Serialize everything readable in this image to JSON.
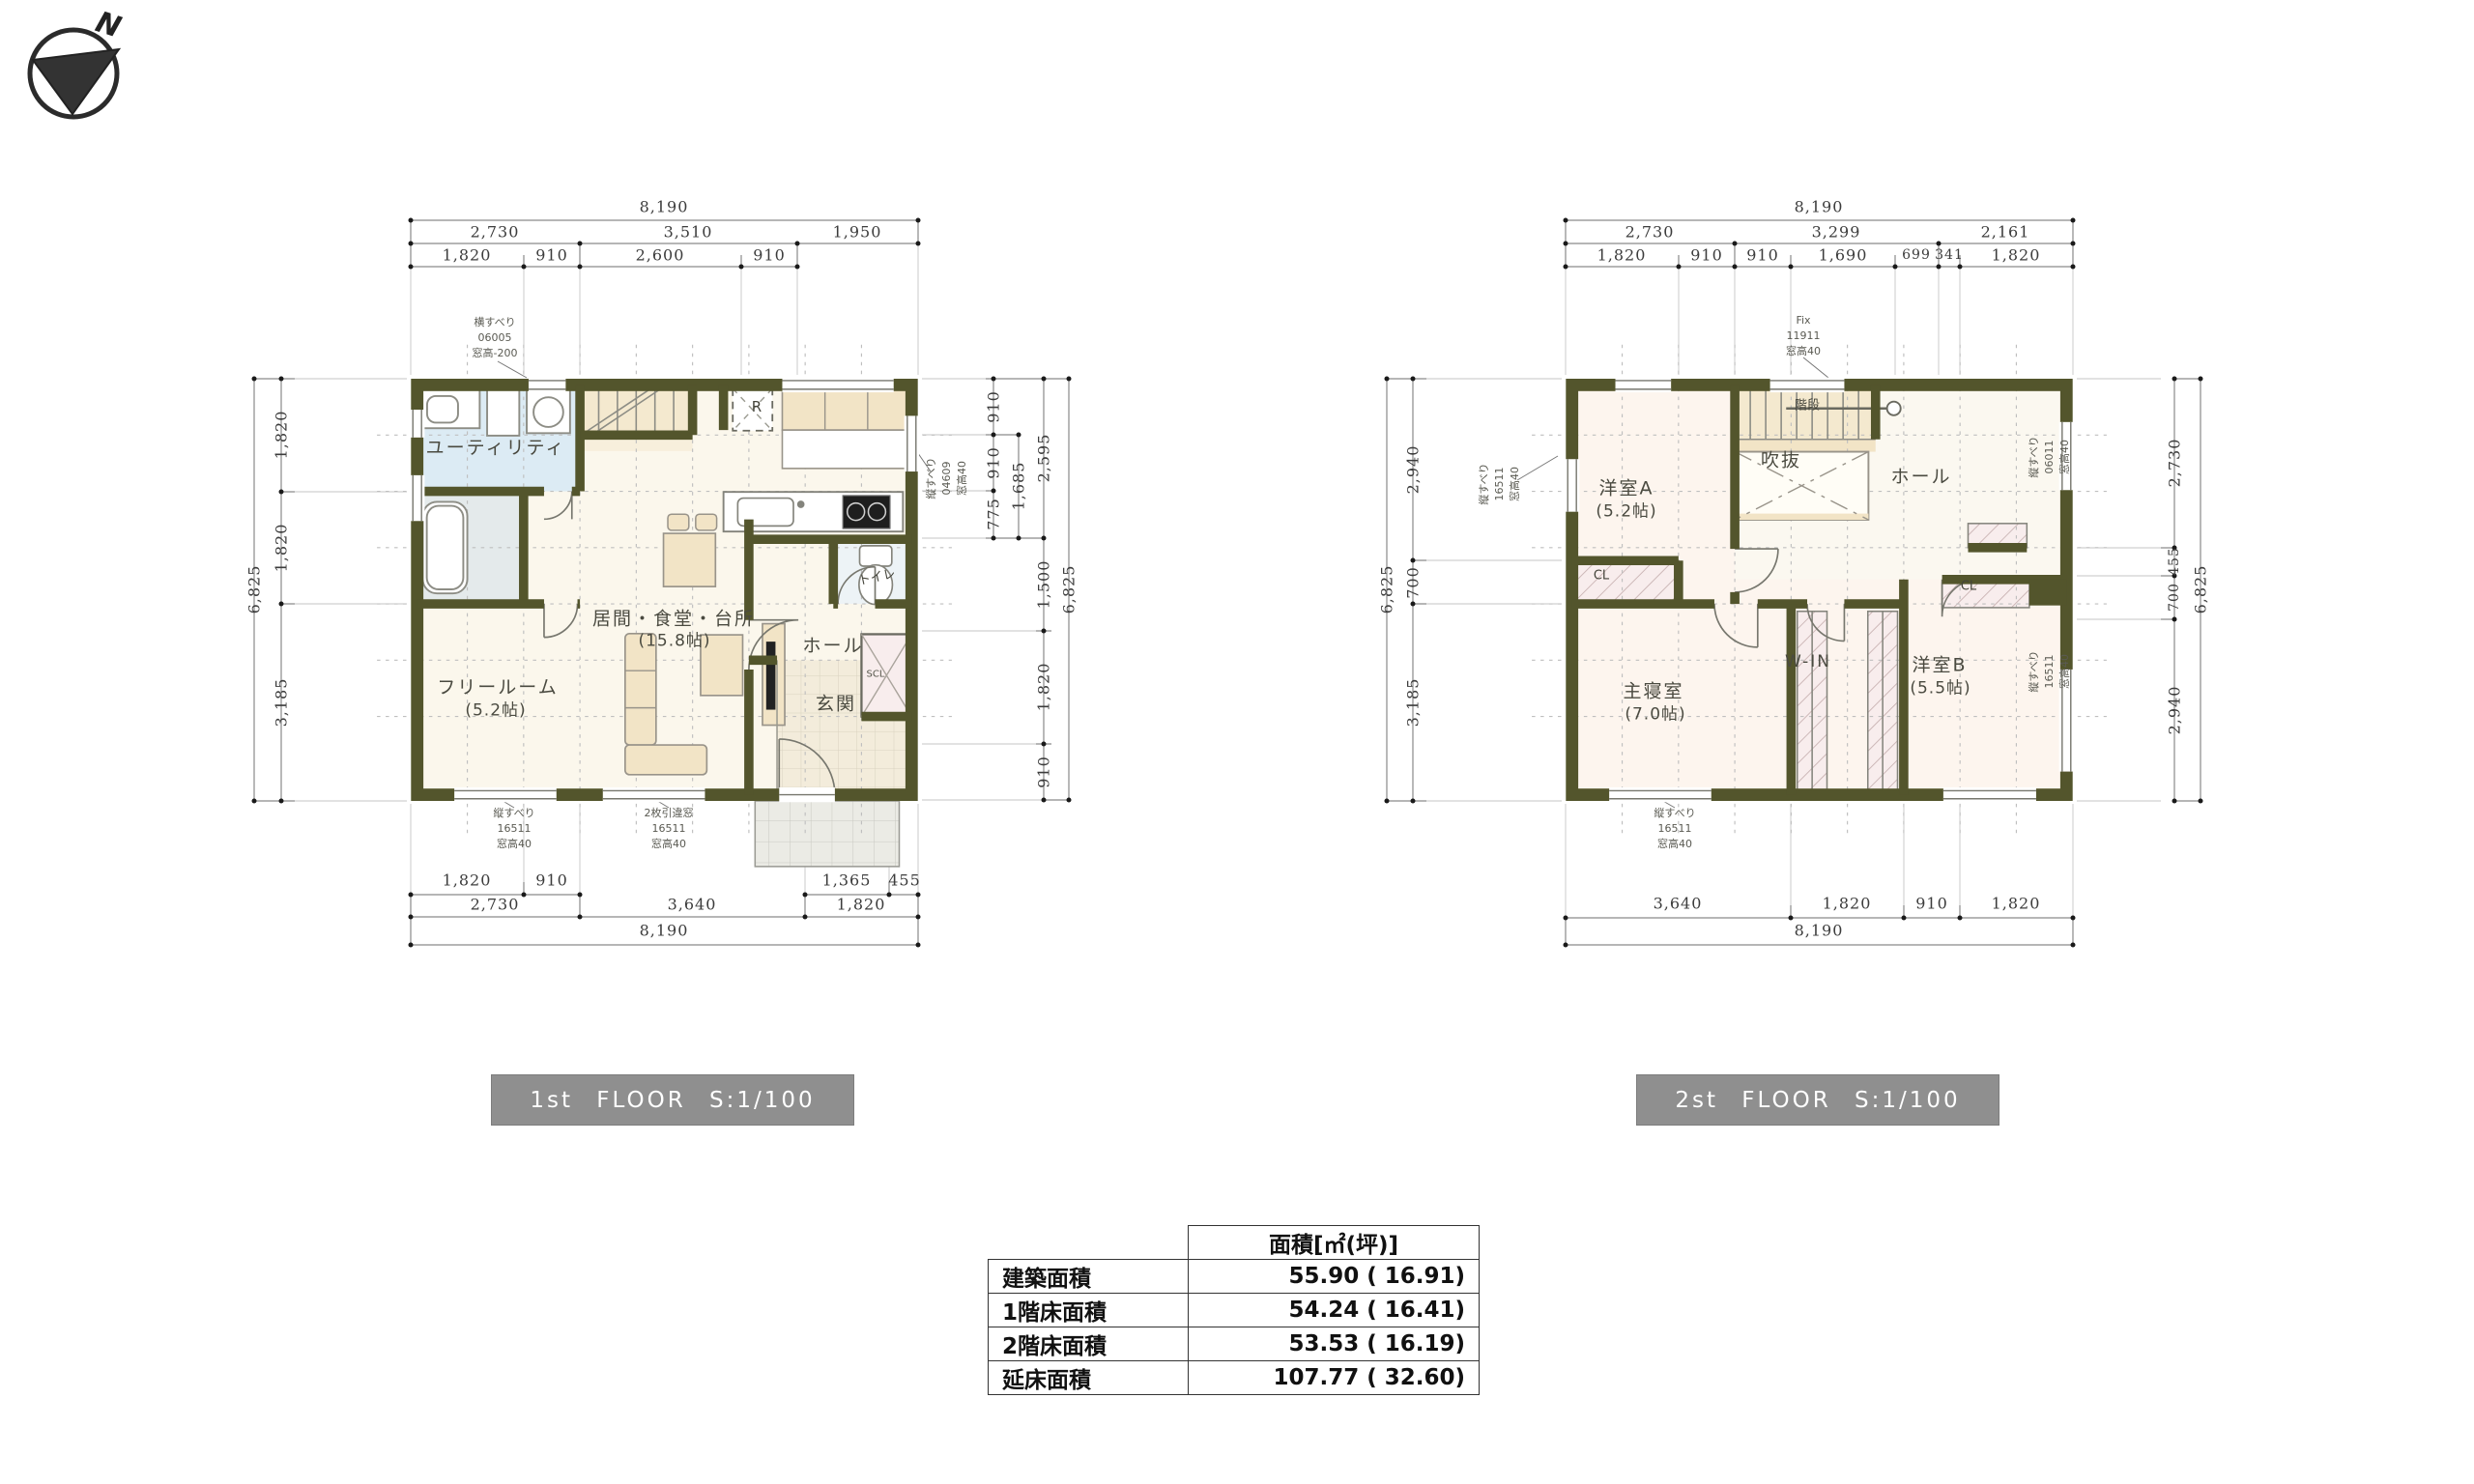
{
  "compass": {
    "north_label": "N"
  },
  "floor1": {
    "badge_label": "1st FLOOR S:1/100",
    "rooms": {
      "utility": "ユーティリティ",
      "free_room": "フリールーム",
      "free_room_size": "(5.2帖)",
      "ldk": "居間・食堂・台所",
      "ldk_size": "(15.8帖)",
      "hall": "ホール",
      "entrance": "玄関",
      "toilet": "トイレ",
      "shoe_closet": "SCL",
      "refrigerator": "R"
    },
    "annotations": {
      "top_window": [
        "横すべり",
        "06005",
        "窓高-200"
      ],
      "right_window": [
        "縦すべり",
        "04609",
        "窓高40"
      ],
      "bottom_left_window": [
        "縦すべり",
        "16511",
        "窓高40"
      ],
      "bottom_center_window": [
        "2枚引違窓",
        "16511",
        "窓高40"
      ]
    },
    "dims": {
      "top_total": "8,190",
      "top_row2": [
        "2,730",
        "3,510",
        "1,950"
      ],
      "top_row3": [
        "1,820",
        "910",
        "2,600",
        "910"
      ],
      "bottom_row1": [
        "1,820",
        "910",
        "1,365",
        "455"
      ],
      "bottom_row2": [
        "2,730",
        "3,640",
        "1,820"
      ],
      "bottom_total": "8,190",
      "left_col1": [
        "1,820",
        "1,820",
        "3,185"
      ],
      "left_total": "6,825",
      "right_col1": [
        "910",
        "910",
        "775"
      ],
      "right_col2": [
        "1,685"
      ],
      "right_col3": [
        "2,595",
        "1,500",
        "1,820",
        "910"
      ],
      "right_total": "6,825"
    }
  },
  "floor2": {
    "badge_label": "2st FLOOR S:1/100",
    "rooms": {
      "room_a": "洋室A",
      "room_a_size": "(5.2帖)",
      "stairs": "階段",
      "void": "吹抜",
      "hall": "ホール",
      "master": "主寝室",
      "master_size": "(7.0帖)",
      "walk_in": "W-IN",
      "room_b": "洋室B",
      "room_b_size": "(5.5帖)",
      "closet_a": "CL",
      "closet_b": "CL"
    },
    "annotations": {
      "top_window": [
        "Fix",
        "11911",
        "窓高40"
      ],
      "left_window": [
        "縦すべり",
        "16511",
        "窓高40"
      ],
      "right_top_window": [
        "縦すべり",
        "06011",
        "窓高40"
      ],
      "right_bottom_window": [
        "縦すべり",
        "16511",
        "窓高40"
      ],
      "bottom_window": [
        "縦すべり",
        "16511",
        "窓高40"
      ]
    },
    "dims": {
      "top_total": "8,190",
      "top_row2": [
        "2,730",
        "3,299",
        "2,161"
      ],
      "top_row3": [
        "1,820",
        "910",
        "910",
        "1,690",
        "699",
        "341",
        "1,820"
      ],
      "bottom_row1": [
        "3,640",
        "1,820",
        "910",
        "1,820"
      ],
      "bottom_total": "8,190",
      "left_col1": [
        "2,940",
        "700",
        "3,185"
      ],
      "left_total": "6,825",
      "right_col1": [
        "2,730",
        "455",
        "700",
        "2,940"
      ],
      "right_total": "6,825"
    }
  },
  "area_table": {
    "header": "面積[㎡(坪)]",
    "rows": [
      {
        "label": "建築面積",
        "value": "55.90 ( 16.91)"
      },
      {
        "label": "1階床面積",
        "value": "54.24 ( 16.41)"
      },
      {
        "label": "2階床面積",
        "value": "53.53 ( 16.19)"
      },
      {
        "label": "延床面積",
        "value": "107.77 ( 32.60)"
      }
    ]
  }
}
